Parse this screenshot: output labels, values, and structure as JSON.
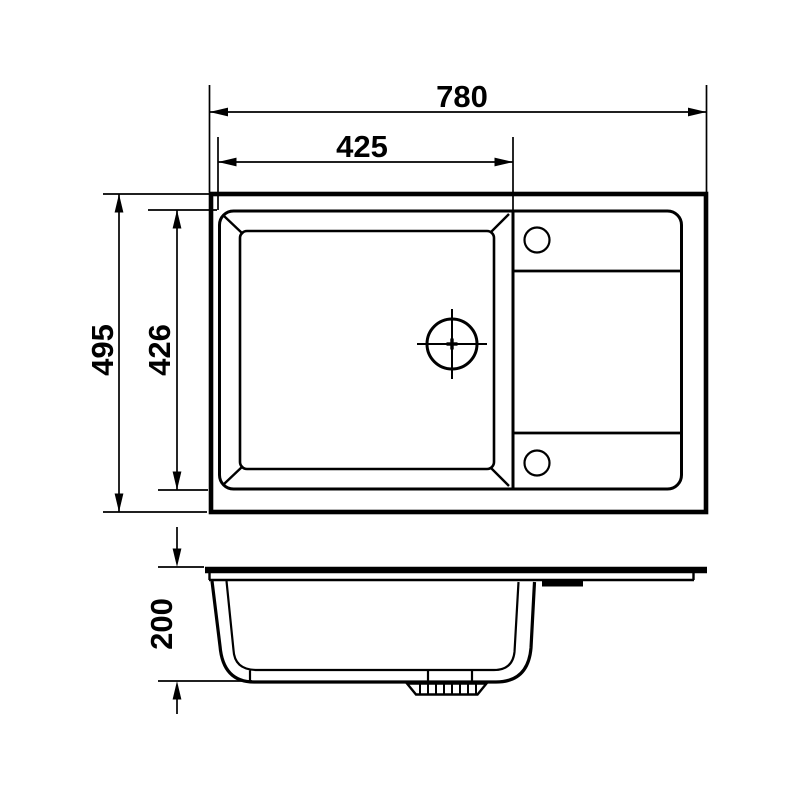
{
  "colors": {
    "line": "#000000",
    "background": "#ffffff"
  },
  "drawing": {
    "type": "sink-dimension-drawing",
    "views": [
      "top-view",
      "side-view"
    ]
  },
  "dimensions": {
    "overall_width": "780",
    "bowl_width": "425",
    "overall_depth": "495",
    "bowl_depth": "426",
    "bowl_height": "200"
  }
}
